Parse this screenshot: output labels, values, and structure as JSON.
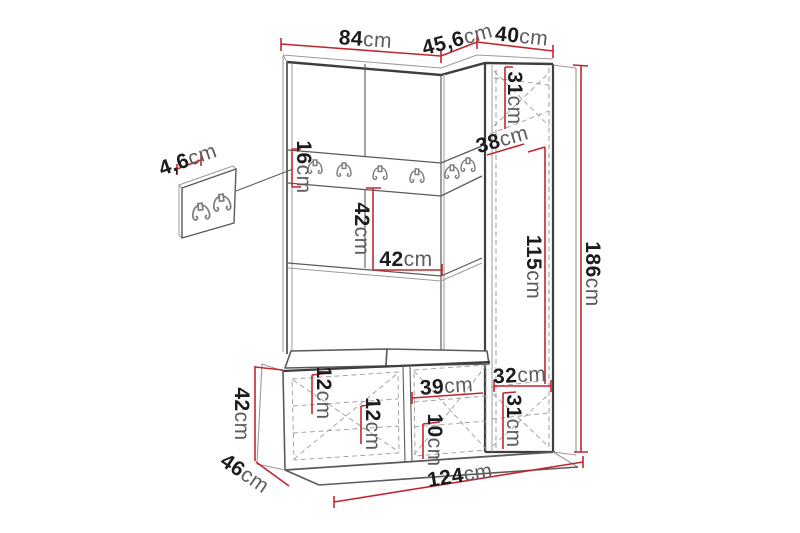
{
  "drawing": {
    "kind": "furniture-dimension-diagram",
    "subject": "hallway wardrobe set with hook rail, tall cabinet and shoe bench"
  },
  "dims": {
    "top_main_width": {
      "num": "84",
      "unit": "cm"
    },
    "top_corner_depth": {
      "num": "45,6",
      "unit": "cm"
    },
    "top_cabinet_width": {
      "num": "40",
      "unit": "cm"
    },
    "panel_thickness": {
      "num": "4,6",
      "unit": "cm"
    },
    "rail_height": {
      "num": "16",
      "unit": "cm"
    },
    "corner_depth": {
      "num": "38",
      "unit": "cm"
    },
    "cabinet_top_section": {
      "num": "31",
      "unit": "cm"
    },
    "mid_section_height": {
      "num": "42",
      "unit": "cm"
    },
    "mid_section_width": {
      "num": "42",
      "unit": "cm"
    },
    "cabinet_inner_height": {
      "num": "115",
      "unit": "cm"
    },
    "total_height": {
      "num": "186",
      "unit": "cm"
    },
    "cabinet_bottom_width": {
      "num": "32",
      "unit": "cm"
    },
    "cabinet_bottom_section": {
      "num": "31",
      "unit": "cm"
    },
    "bench_height": {
      "num": "42",
      "unit": "cm"
    },
    "bench_depth": {
      "num": "46",
      "unit": "cm"
    },
    "total_width": {
      "num": "124",
      "unit": "cm"
    },
    "bench_top_height": {
      "num": "12",
      "unit": "cm"
    },
    "bench_inner_height": {
      "num": "12",
      "unit": "cm"
    },
    "bench_right_width": {
      "num": "39",
      "unit": "cm"
    },
    "bench_shelf_height": {
      "num": "10",
      "unit": "cm"
    }
  },
  "icons": {
    "coat_hook": "double-coat-hook"
  },
  "counts": {
    "rail_hooks": 6,
    "panel_hooks": 2
  },
  "colors": {
    "dimension_line": "#c2272d",
    "outline_dark": "#3e3e3e",
    "outline_mid": "#5a5a5a",
    "outline_light": "#9b9b9b",
    "label_number": "#1c1c1c",
    "label_unit": "#5d5d5d",
    "hook_color": "#7d7d7d",
    "background": "#ffffff"
  }
}
